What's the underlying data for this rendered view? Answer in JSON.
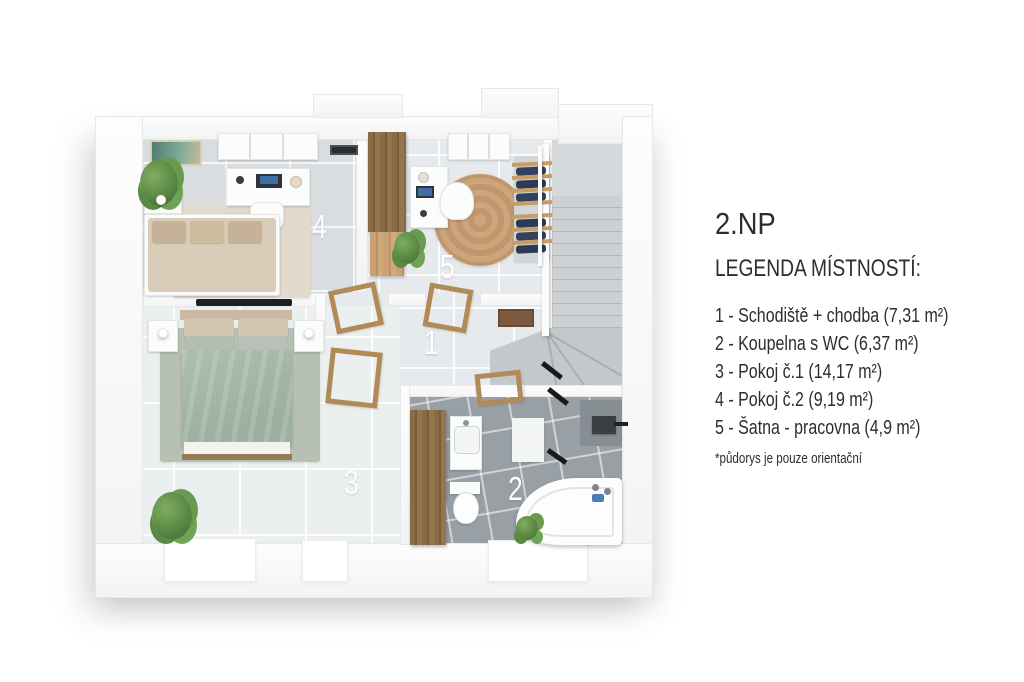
{
  "title": "2.NP",
  "legend": {
    "heading": "LEGENDA MÍSTNOSTÍ:",
    "items": [
      "1 - Schodiště + chodba (7,31 m²)",
      "2 - Koupelna s WC (6,37 m²)",
      "3 - Pokoj č.1 (14,17 m²)",
      "4 - Pokoj č.2 (9,19 m²)",
      "5 - Šatna - pracovna (4,9 m²)"
    ],
    "footnote": "*půdorys je pouze orientační"
  },
  "plan": {
    "rooms": [
      {
        "num": "1",
        "name": "Schodiště + chodba"
      },
      {
        "num": "2",
        "name": "Koupelna s WC"
      },
      {
        "num": "3",
        "name": "Pokoj č.1"
      },
      {
        "num": "4",
        "name": "Pokoj č.2"
      },
      {
        "num": "5",
        "name": "Šatna - pracovna"
      }
    ]
  },
  "colors": {
    "wood": "#8a6b47",
    "wood_light": "#c9a173",
    "room_tile": "#d9dde0",
    "bath_tile": "#99a0a5",
    "sage_bed": "#a9bcab",
    "jute_rug": "#c9a074",
    "text": "#2d2d2d"
  }
}
